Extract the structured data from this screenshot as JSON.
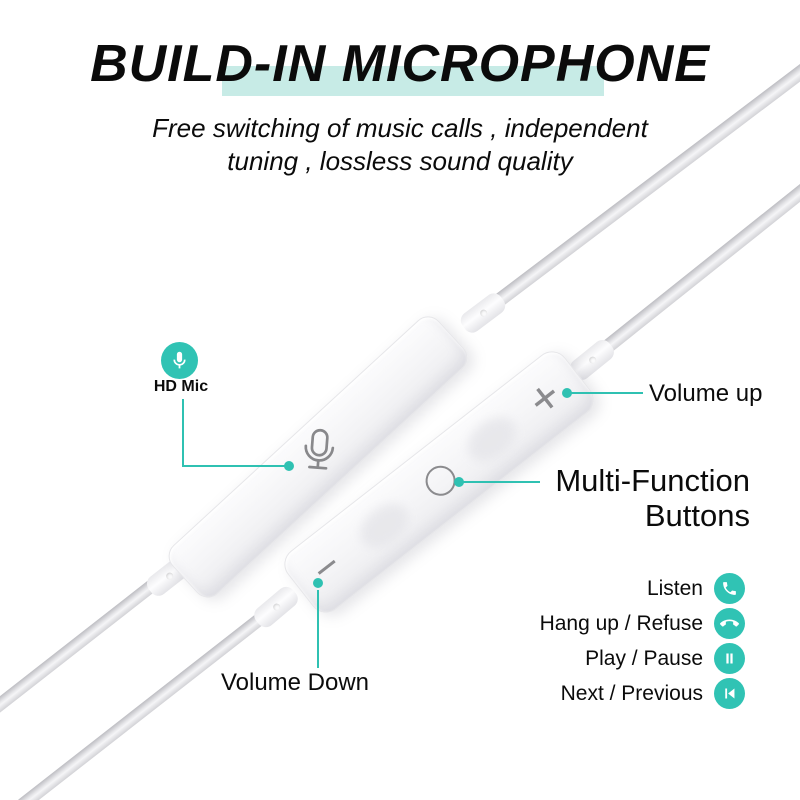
{
  "header": {
    "title": "BUILD-IN MICROPHONE",
    "subtitle_line1": "Free switching of music calls , independent",
    "subtitle_line2": "tuning , lossless sound quality"
  },
  "callouts": {
    "hd_mic": {
      "label": "HD Mic",
      "icon": "microphone-icon"
    },
    "volume_up": {
      "label": "Volume up"
    },
    "multi_function": {
      "label_line1": "Multi-Function",
      "label_line2": "Buttons"
    },
    "volume_down": {
      "label": "Volume Down"
    }
  },
  "features": [
    {
      "label": "Listen",
      "icon": "phone-call-icon"
    },
    {
      "label": "Hang up / Refuse",
      "icon": "phone-hangup-icon"
    },
    {
      "label": "Play / Pause",
      "icon": "pause-icon"
    },
    {
      "label": "Next / Previous",
      "icon": "skip-previous-icon"
    }
  ],
  "product": {
    "front_markings": {
      "volume_up": "+",
      "volume_down": "−"
    },
    "back_marking_icon": "microphone-icon"
  },
  "colors": {
    "accent_teal": "#2fc1b2",
    "icon_teal": "#30c3b4",
    "highlight_mint": "#c7ebe6",
    "marking_gray": "#8b8b8e",
    "text": "#0b0b0b"
  }
}
